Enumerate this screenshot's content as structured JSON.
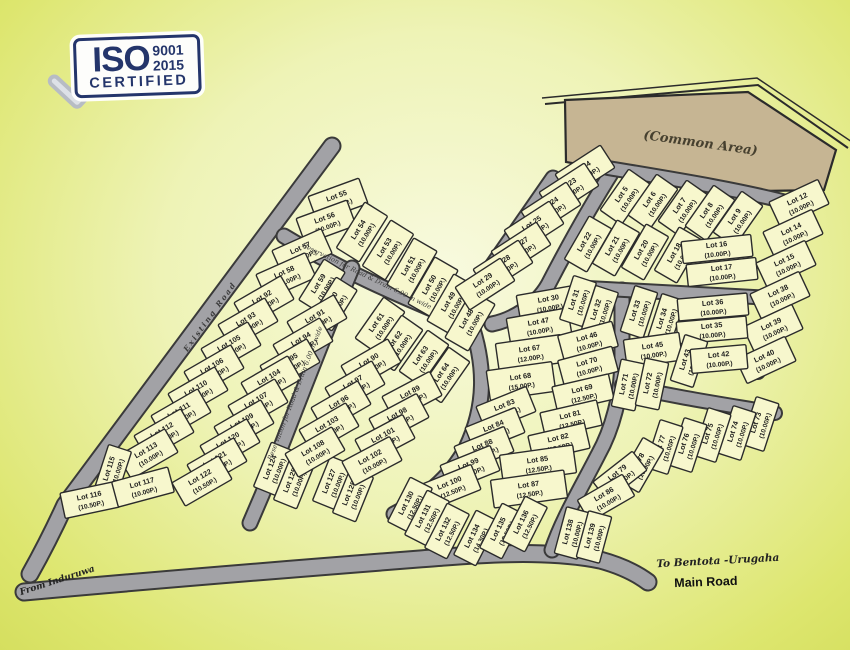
{
  "badge": {
    "iso": "ISO",
    "code": "9001",
    "year": "2015",
    "certified": "CERTIFIED"
  },
  "labels": {
    "common_area": "(Common Area)",
    "existing_road": "Existing Road",
    "reservation_top": "Reservation for Road & Drain 6.00 m wide",
    "reservation_mid": "Reservation for Road & Drain 6.00 m wide",
    "from_induruwa": "From Induruwa",
    "to_bentota": "To Bentota -Urugaha",
    "main_road": "Main Road"
  },
  "colors": {
    "lot_fill": "#f7f7cd",
    "lot_stroke": "#2b2b2b",
    "road_fill": "#a2a2a6",
    "road_casing": "#3a3a3a",
    "common_fill": "#c6b593",
    "common_stroke": "#2b2b2b",
    "badge_navy": "#24356b",
    "background_center": "#f8fadf",
    "background_edge": "#dde66e"
  },
  "lots": [
    {
      "label": "Lot 55",
      "size": "(10.00P.)",
      "x": 338,
      "y": 200,
      "r": -20
    },
    {
      "label": "Lot 56",
      "size": "(10.00P.)",
      "x": 326,
      "y": 222,
      "r": -20
    },
    {
      "label": "Lot 54",
      "size": "(10.00P.)",
      "x": 362,
      "y": 232,
      "r": -58
    },
    {
      "label": "Lot 53",
      "size": "(10.00P.)",
      "x": 388,
      "y": 250,
      "r": -58
    },
    {
      "label": "Lot 51",
      "size": "(10.00P.)",
      "x": 412,
      "y": 268,
      "r": -60
    },
    {
      "label": "Lot 50",
      "size": "(10.00P.)",
      "x": 433,
      "y": 287,
      "r": -60
    },
    {
      "label": "Lot 49",
      "size": "(10.00P.)",
      "x": 452,
      "y": 304,
      "r": -60
    },
    {
      "label": "Lot 48",
      "size": "(10.00P.)",
      "x": 470,
      "y": 321,
      "r": -60
    },
    {
      "label": "Lot 57",
      "size": "(10.00P.)",
      "x": 302,
      "y": 252,
      "r": -24
    },
    {
      "label": "Lot 58",
      "size": "(10.00P.)",
      "x": 286,
      "y": 276,
      "r": -24
    },
    {
      "label": "Lot 59",
      "size": "(10.00P.)",
      "x": 322,
      "y": 286,
      "r": -58,
      "w": 48,
      "h": 25
    },
    {
      "label": "Lot 60",
      "size": "(10.00P.)",
      "x": 334,
      "y": 304,
      "r": -58,
      "w": 48,
      "h": 25
    },
    {
      "label": "Lot 61",
      "size": "(10.00P.)",
      "x": 380,
      "y": 325,
      "r": -55,
      "w": 50,
      "h": 26
    },
    {
      "label": "Lot 62",
      "size": "(10.00P.)",
      "x": 398,
      "y": 343,
      "r": -55,
      "w": 50,
      "h": 26
    },
    {
      "label": "Lot 63",
      "size": "(10.00P.)",
      "x": 424,
      "y": 358,
      "r": -55,
      "w": 50,
      "h": 26
    },
    {
      "label": "Lot 64",
      "size": "(10.00P.)",
      "x": 445,
      "y": 375,
      "r": -55,
      "w": 50,
      "h": 26
    },
    {
      "label": "Lot 92",
      "size": "(10.00P.)",
      "x": 264,
      "y": 301,
      "r": -30
    },
    {
      "label": "Lot 93",
      "size": "(10.00P.)",
      "x": 248,
      "y": 323,
      "r": -30
    },
    {
      "label": "Lot 105",
      "size": "(10.00P.)",
      "x": 231,
      "y": 347,
      "r": -30
    },
    {
      "label": "Lot 106",
      "size": "(10.00P.)",
      "x": 214,
      "y": 370,
      "r": -30
    },
    {
      "label": "Lot 110",
      "size": "(10.00P.)",
      "x": 198,
      "y": 392,
      "r": -30
    },
    {
      "label": "Lot 111",
      "size": "(10.00P.)",
      "x": 181,
      "y": 414,
      "r": -30
    },
    {
      "label": "Lot 112",
      "size": "(10.00P.)",
      "x": 164,
      "y": 434,
      "r": -30
    },
    {
      "label": "Lot 113",
      "size": "(10.00P.)",
      "x": 148,
      "y": 454,
      "r": -30
    },
    {
      "label": "Lot 115",
      "size": "(10.00P.)",
      "x": 113,
      "y": 470,
      "r": -72,
      "w": 46,
      "h": 24
    },
    {
      "label": "Lot 116",
      "size": "(10.50P.)",
      "x": 90,
      "y": 500,
      "r": -12,
      "w": 56,
      "h": 26
    },
    {
      "label": "Lot 117",
      "size": "(10.00P.)",
      "x": 143,
      "y": 487,
      "r": -15,
      "w": 58,
      "h": 26
    },
    {
      "label": "Lot 91",
      "size": "(10.00P.)",
      "x": 317,
      "y": 320,
      "r": -30
    },
    {
      "label": "Lot 94",
      "size": "(10.00P.)",
      "x": 303,
      "y": 343,
      "r": -30
    },
    {
      "label": "Lot 95",
      "size": "(10.00P.)",
      "x": 290,
      "y": 364,
      "r": -30
    },
    {
      "label": "Lot 104",
      "size": "(10.00P.)",
      "x": 271,
      "y": 381,
      "r": -30
    },
    {
      "label": "Lot 107",
      "size": "(10.00P.)",
      "x": 258,
      "y": 404,
      "r": -30
    },
    {
      "label": "Lot 109",
      "size": "(10.00P.)",
      "x": 244,
      "y": 425,
      "r": -30
    },
    {
      "label": "Lot 120",
      "size": "(10.00P.)",
      "x": 230,
      "y": 444,
      "r": -30
    },
    {
      "label": "Lot 121",
      "size": "(10.00P.)",
      "x": 217,
      "y": 463,
      "r": -30
    },
    {
      "label": "Lot 122",
      "size": "(10.50P.)",
      "x": 202,
      "y": 481,
      "r": -30
    },
    {
      "label": "Lot 124",
      "size": "(10.00P.)",
      "x": 274,
      "y": 469,
      "r": -68,
      "w": 48,
      "h": 25
    },
    {
      "label": "Lot 125",
      "size": "(10.00P.)",
      "x": 294,
      "y": 482,
      "r": -68,
      "w": 48,
      "h": 25
    },
    {
      "label": "Lot 127",
      "size": "(10.00P.)",
      "x": 333,
      "y": 483,
      "r": -68,
      "w": 48,
      "h": 25
    },
    {
      "label": "Lot 128",
      "size": "(10.00P.)",
      "x": 353,
      "y": 495,
      "r": -68,
      "w": 48,
      "h": 25
    },
    {
      "label": "Lot 90",
      "size": "(10.00P.)",
      "x": 371,
      "y": 364,
      "r": -30
    },
    {
      "label": "Lot 97",
      "size": "(10.00P.)",
      "x": 355,
      "y": 386,
      "r": -30
    },
    {
      "label": "Lot 96",
      "size": "(10.00P.)",
      "x": 341,
      "y": 406,
      "r": -30
    },
    {
      "label": "Lot 103",
      "size": "(10.00P.)",
      "x": 329,
      "y": 428,
      "r": -30
    },
    {
      "label": "Lot 108",
      "size": "(10.00P.)",
      "x": 315,
      "y": 452,
      "r": -30
    },
    {
      "label": "Lot 89",
      "size": "(10.00P.)",
      "x": 412,
      "y": 396,
      "r": -28
    },
    {
      "label": "Lot 98",
      "size": "(10.00P.)",
      "x": 399,
      "y": 418,
      "r": -28
    },
    {
      "label": "Lot 101",
      "size": "(10.00P.)",
      "x": 385,
      "y": 439,
      "r": -28
    },
    {
      "label": "Lot 102",
      "size": "(10.00P.)",
      "x": 372,
      "y": 461,
      "r": -28
    },
    {
      "label": "Lot 4",
      "size": "(10.00P.)",
      "x": 585,
      "y": 171,
      "r": -33
    },
    {
      "label": "Lot 23",
      "size": "(10.00P.)",
      "x": 569,
      "y": 189,
      "r": -33
    },
    {
      "label": "Lot 24",
      "size": "(10.00P.)",
      "x": 551,
      "y": 208,
      "r": -33
    },
    {
      "label": "Lot 25",
      "size": "(10.00P.)",
      "x": 534,
      "y": 227,
      "r": -33
    },
    {
      "label": "Lot 27",
      "size": "(10.00P.)",
      "x": 521,
      "y": 248,
      "r": -33
    },
    {
      "label": "Lot 28",
      "size": "(10.00P.)",
      "x": 503,
      "y": 266,
      "r": -33
    },
    {
      "label": "Lot 29",
      "size": "(10.00P.)",
      "x": 485,
      "y": 284,
      "r": -33
    },
    {
      "label": "Lot 30",
      "size": "(10.00P.)",
      "x": 549,
      "y": 303,
      "r": -10,
      "w": 62,
      "h": 26
    },
    {
      "label": "Lot 47",
      "size": "(10.00P.)",
      "x": 539,
      "y": 326,
      "r": -10,
      "w": 62,
      "h": 26
    },
    {
      "label": "Lot 67",
      "size": "(12.00P.)",
      "x": 530,
      "y": 353,
      "r": -8,
      "w": 66,
      "h": 28
    },
    {
      "label": "Lot 68",
      "size": "(15.00P.)",
      "x": 521,
      "y": 381,
      "r": -8,
      "w": 66,
      "h": 30
    },
    {
      "label": "Lot 83",
      "size": "(12.50P.)",
      "x": 506,
      "y": 409,
      "r": -22
    },
    {
      "label": "Lot 84",
      "size": "(12.50P.)",
      "x": 495,
      "y": 430,
      "r": -22
    },
    {
      "label": "Lot 88",
      "size": "(12.50P.)",
      "x": 484,
      "y": 449,
      "r": -22
    },
    {
      "label": "Lot 99",
      "size": "(12.50P.)",
      "x": 470,
      "y": 468,
      "r": -22
    },
    {
      "label": "Lot 100",
      "size": "(12.50P.)",
      "x": 451,
      "y": 487,
      "r": -22
    },
    {
      "label": "Lot 31",
      "size": "(10.00P.)",
      "x": 578,
      "y": 301,
      "r": -72,
      "w": 46,
      "h": 24
    },
    {
      "label": "Lot 32",
      "size": "(10.00P.)",
      "x": 600,
      "y": 311,
      "r": -72,
      "w": 46,
      "h": 24
    },
    {
      "label": "Lot 46",
      "size": "(10.00P.)",
      "x": 588,
      "y": 341,
      "r": -15,
      "w": 56,
      "h": 26
    },
    {
      "label": "Lot 70",
      "size": "(10.00P.)",
      "x": 588,
      "y": 366,
      "r": -15,
      "w": 56,
      "h": 26
    },
    {
      "label": "Lot 69",
      "size": "(12.50P.)",
      "x": 583,
      "y": 393,
      "r": -13,
      "w": 58,
      "h": 26
    },
    {
      "label": "Lot 81",
      "size": "(12.50P.)",
      "x": 571,
      "y": 419,
      "r": -13,
      "w": 58,
      "h": 26
    },
    {
      "label": "Lot 82",
      "size": "(12.50P.)",
      "x": 559,
      "y": 442,
      "r": -13,
      "w": 58,
      "h": 26
    },
    {
      "label": "Lot 85",
      "size": "(12.50P.)",
      "x": 538,
      "y": 464,
      "r": -8,
      "w": 74,
      "h": 28
    },
    {
      "label": "Lot 87",
      "size": "(12.50P.)",
      "x": 529,
      "y": 489,
      "r": -8,
      "w": 74,
      "h": 28
    },
    {
      "label": "Lot 130",
      "size": "(12.50P.)",
      "x": 410,
      "y": 505,
      "r": -63,
      "w": 50,
      "h": 25
    },
    {
      "label": "Lot 131",
      "size": "(12.50P.)",
      "x": 427,
      "y": 518,
      "r": -63,
      "w": 50,
      "h": 25
    },
    {
      "label": "Lot 132",
      "size": "(12.50P.)",
      "x": 447,
      "y": 531,
      "r": -63,
      "w": 50,
      "h": 25
    },
    {
      "label": "Lot 134",
      "size": "(14.30P.)",
      "x": 476,
      "y": 538,
      "r": -63,
      "w": 50,
      "h": 25
    },
    {
      "label": "Lot 135",
      "size": "(12.50P.)",
      "x": 502,
      "y": 531,
      "r": -63,
      "w": 50,
      "h": 25
    },
    {
      "label": "Lot 136",
      "size": "(12.50P.)",
      "x": 525,
      "y": 524,
      "r": -63,
      "w": 50,
      "h": 25
    },
    {
      "label": "Lot 5",
      "size": "(10.00P.)",
      "x": 625,
      "y": 197,
      "r": -55,
      "w": 50,
      "h": 26
    },
    {
      "label": "Lot 6",
      "size": "(10.00P.)",
      "x": 653,
      "y": 202,
      "r": -55,
      "w": 50,
      "h": 26
    },
    {
      "label": "Lot 7",
      "size": "(10.00P.)",
      "x": 683,
      "y": 208,
      "r": -55,
      "w": 50,
      "h": 26
    },
    {
      "label": "Lot 8",
      "size": "(10.00P.)",
      "x": 710,
      "y": 213,
      "r": -55,
      "w": 50,
      "h": 26
    },
    {
      "label": "Lot 9",
      "size": "(10.00P.)",
      "x": 738,
      "y": 219,
      "r": -55,
      "w": 50,
      "h": 26
    },
    {
      "label": "Lot 22",
      "size": "(10.00P.)",
      "x": 588,
      "y": 244,
      "r": -60,
      "w": 50,
      "h": 26
    },
    {
      "label": "Lot 21",
      "size": "(10.00P.)",
      "x": 616,
      "y": 248,
      "r": -60,
      "w": 50,
      "h": 26
    },
    {
      "label": "Lot 20",
      "size": "(10.00P.)",
      "x": 645,
      "y": 252,
      "r": -60,
      "w": 50,
      "h": 26
    },
    {
      "label": "Lot 18",
      "size": "(10.00P.)",
      "x": 678,
      "y": 255,
      "r": -60,
      "w": 50,
      "h": 26
    },
    {
      "label": "Lot 16",
      "size": "(10.00P.)",
      "x": 717,
      "y": 249,
      "r": -6,
      "w": 70,
      "h": 22
    },
    {
      "label": "Lot 17",
      "size": "(10.00P.)",
      "x": 722,
      "y": 272,
      "r": -6,
      "w": 70,
      "h": 22
    },
    {
      "label": "Lot 12",
      "size": "(10.00P.)",
      "x": 799,
      "y": 203,
      "r": -25
    },
    {
      "label": "Lot 14",
      "size": "(10.00P.)",
      "x": 793,
      "y": 233,
      "r": -25
    },
    {
      "label": "Lot 15",
      "size": "(10.00P.)",
      "x": 786,
      "y": 264,
      "r": -25
    },
    {
      "label": "Lot 38",
      "size": "(10.00P.)",
      "x": 780,
      "y": 295,
      "r": -25
    },
    {
      "label": "Lot 39",
      "size": "(10.00P.)",
      "x": 773,
      "y": 328,
      "r": -25
    },
    {
      "label": "Lot 40",
      "size": "(10.00P.)",
      "x": 766,
      "y": 360,
      "r": -25
    },
    {
      "label": "Lot 33",
      "size": "(10.00P.)",
      "x": 639,
      "y": 312,
      "r": -72,
      "w": 48,
      "h": 24
    },
    {
      "label": "Lot 34",
      "size": "(10.00P.)",
      "x": 666,
      "y": 320,
      "r": -72,
      "w": 48,
      "h": 24
    },
    {
      "label": "Lot 36",
      "size": "(10.00P.)",
      "x": 713,
      "y": 307,
      "r": -5,
      "w": 70,
      "h": 22
    },
    {
      "label": "Lot 35",
      "size": "(10.00P.)",
      "x": 712,
      "y": 330,
      "r": -5,
      "w": 70,
      "h": 22
    },
    {
      "label": "Lot 45",
      "size": "(10.00P.)",
      "x": 653,
      "y": 350,
      "r": -8,
      "w": 56,
      "h": 28
    },
    {
      "label": "Lot 43",
      "size": "(10.00P.)",
      "x": 689,
      "y": 361,
      "r": -72,
      "w": 48,
      "h": 24
    },
    {
      "label": "Lot 42",
      "size": "(10.00P.)",
      "x": 719,
      "y": 359,
      "r": -5,
      "w": 56,
      "h": 24
    },
    {
      "label": "Lot 71",
      "size": "(10.00P.)",
      "x": 628,
      "y": 385,
      "r": -78,
      "w": 48,
      "h": 24
    },
    {
      "label": "Lot 72",
      "size": "(10.00P.)",
      "x": 652,
      "y": 384,
      "r": -78,
      "w": 48,
      "h": 24
    },
    {
      "label": "Lot 73",
      "size": "(10.00P.)",
      "x": 760,
      "y": 424,
      "r": -72,
      "w": 50,
      "h": 24
    },
    {
      "label": "Lot 74",
      "size": "(10.00P.)",
      "x": 737,
      "y": 433,
      "r": -72,
      "w": 50,
      "h": 24
    },
    {
      "label": "Lot 75",
      "size": "(10.00P.)",
      "x": 712,
      "y": 435,
      "r": -72,
      "w": 50,
      "h": 24
    },
    {
      "label": "Lot 76",
      "size": "(10.00P.)",
      "x": 688,
      "y": 445,
      "r": -72,
      "w": 50,
      "h": 24
    },
    {
      "label": "Lot 77",
      "size": "(10.00P.)",
      "x": 664,
      "y": 447,
      "r": -72,
      "w": 50,
      "h": 24
    },
    {
      "label": "Lot 78",
      "size": "(10.00P.)",
      "x": 641,
      "y": 465,
      "r": -60,
      "w": 50,
      "h": 24
    },
    {
      "label": "Lot 79",
      "size": "(10.00P.)",
      "x": 620,
      "y": 476,
      "r": -38,
      "w": 50,
      "h": 24
    },
    {
      "label": "Lot 86",
      "size": "(10.00P.)",
      "x": 606,
      "y": 498,
      "r": -30,
      "w": 52,
      "h": 25
    },
    {
      "label": "Lot 138",
      "size": "(10.00P.)",
      "x": 572,
      "y": 533,
      "r": -75,
      "w": 48,
      "h": 24
    },
    {
      "label": "Lot 139",
      "size": "(10.00P.)",
      "x": 594,
      "y": 537,
      "r": -75,
      "w": 48,
      "h": 24
    }
  ]
}
